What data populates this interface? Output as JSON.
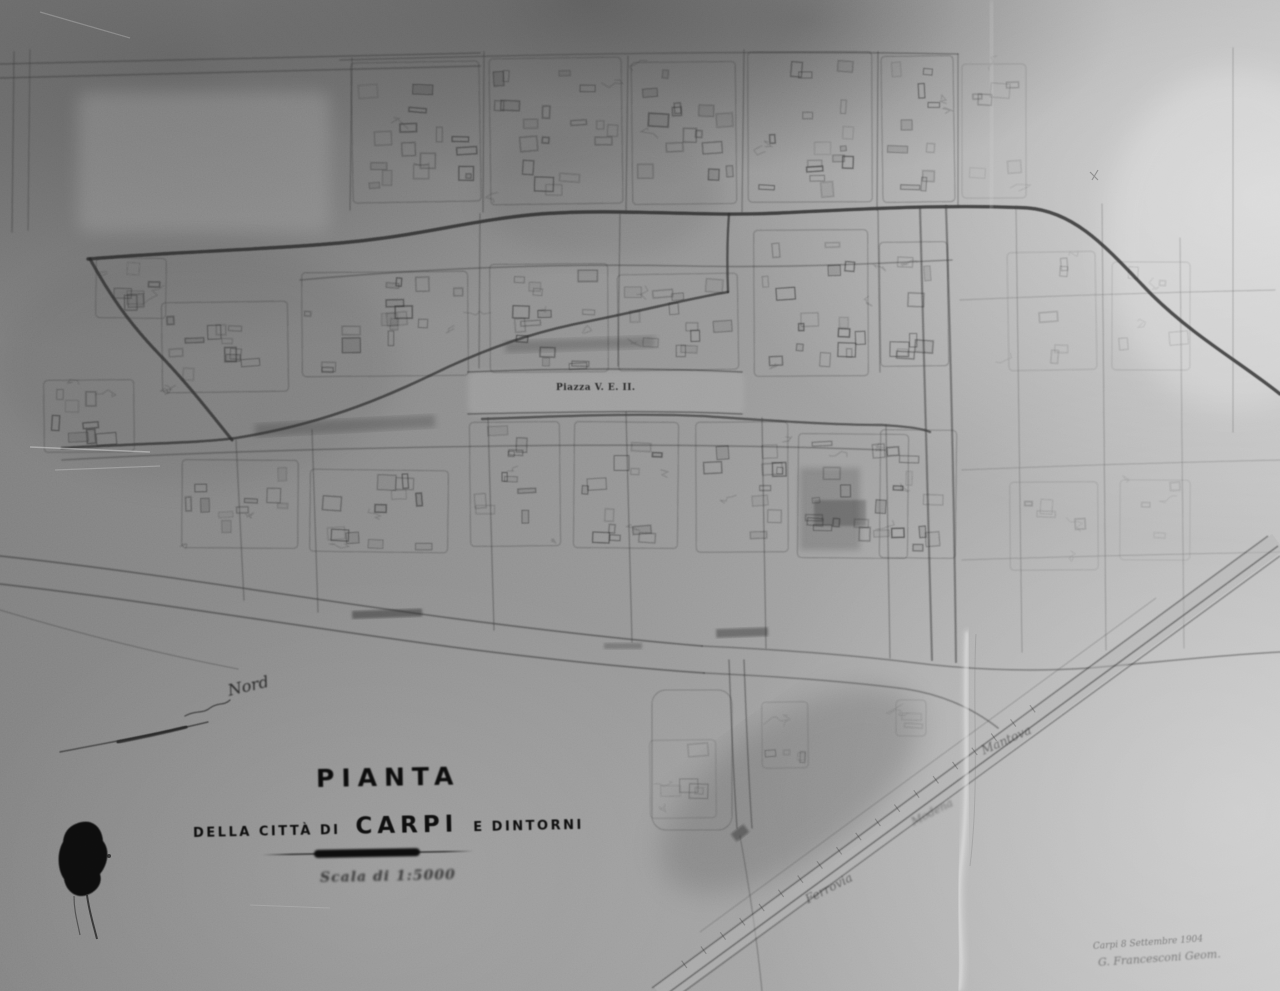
{
  "title_block": {
    "title": "PIANTA",
    "subtitle_prefix": "DELLA CITTÀ DI",
    "subtitle_city": "CARPI",
    "subtitle_suffix": "E DINTORNI",
    "scale_text": "Scala di 1:5000"
  },
  "map_labels": {
    "piazza": "Piazza V. E. II.",
    "nord_note": "Nord",
    "railway": {
      "ferrovia": "Ferrovia",
      "modena": "Modena",
      "mantova": "Mantova"
    }
  },
  "inscription": {
    "date_line": "Carpi 8 Settembre 1904",
    "signature_line": "G. Francesconi Geom."
  },
  "colors": {
    "paper_dark": "#777777",
    "paper_mid": "#9e9e9e",
    "paper_light": "#c6c6c6",
    "ink": "#1a1a1a",
    "linework": "#3b3b3b"
  }
}
